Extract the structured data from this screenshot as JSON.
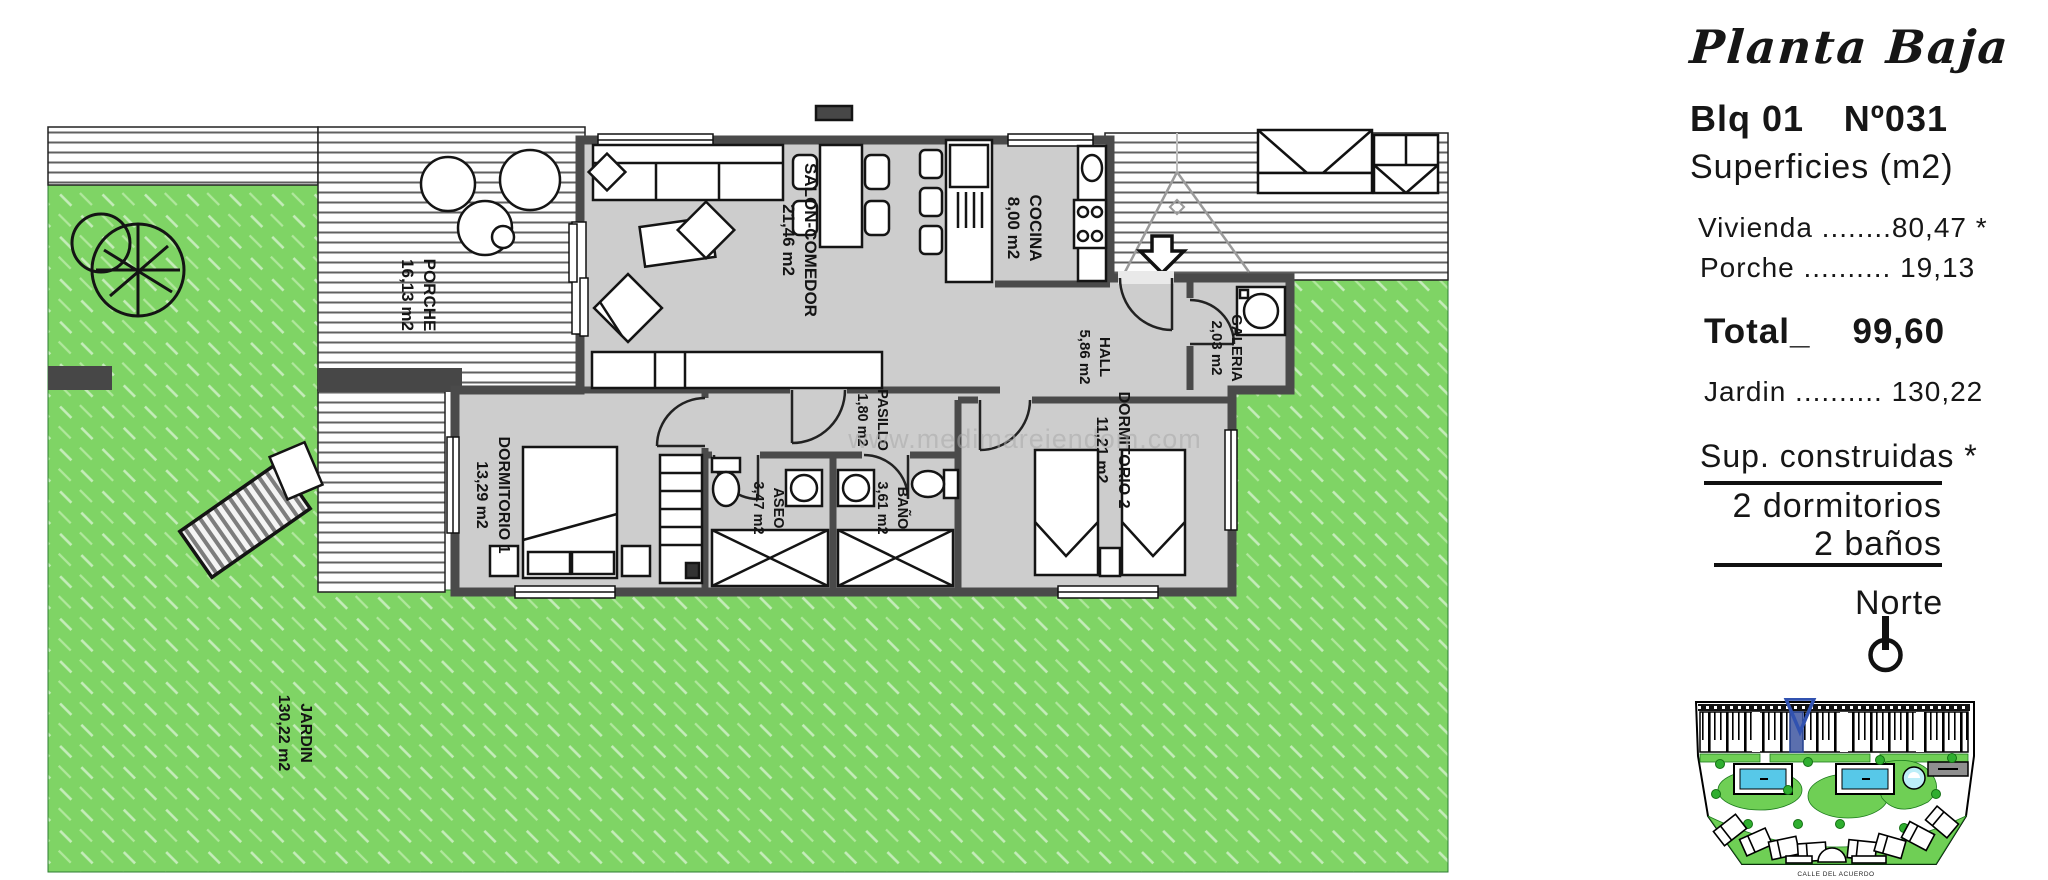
{
  "panel": {
    "plan_title": "Planta Baja",
    "block": "Blq 01",
    "number": "Nº031",
    "surfaces_heading": "Superficies (m2)",
    "line_vivienda": "Vivienda ........80,47 *",
    "line_porche": "Porche .......... 19,13",
    "total_label": "Total_",
    "total_value": "99,60",
    "line_jardin": "Jardin .......... 130,22",
    "sup_heading": "Sup. construidas *",
    "bedrooms": "2 dormitorios",
    "baths": "2 baños",
    "north_label": "Norte"
  },
  "plan": {
    "watermark": "www.medimareiendom.com",
    "rooms": [
      {
        "name": "PORCHE",
        "area": "16,13 m2"
      },
      {
        "name": "SALON-COMEDOR",
        "area": "21,46 m2"
      },
      {
        "name": "COCINA",
        "area": "8,00 m2"
      },
      {
        "name": "HALL",
        "area": "5,86 m2"
      },
      {
        "name": "GALERIA",
        "area": "2,03 m2"
      },
      {
        "name": "PASILLO",
        "area": "1,80 m2"
      },
      {
        "name": "DORMITORIO 1",
        "area": "13,29 m2"
      },
      {
        "name": "ASEO",
        "area": "3,47 m2"
      },
      {
        "name": "BAÑO",
        "area": "3,61 m2"
      },
      {
        "name": "DORMITORIO 2",
        "area": "11,21 m2"
      },
      {
        "name": "JARDIN",
        "area": "130,22 m2"
      }
    ]
  },
  "site": {
    "street": "CALLE DEL ACUERDO"
  },
  "colors": {
    "garden_green": "#7fd465",
    "interior_gray": "#cdcdcd",
    "wall_gray": "#4a4a4a",
    "pool_cyan": "#57c8e8",
    "marker_blue": "#5b6fae"
  }
}
